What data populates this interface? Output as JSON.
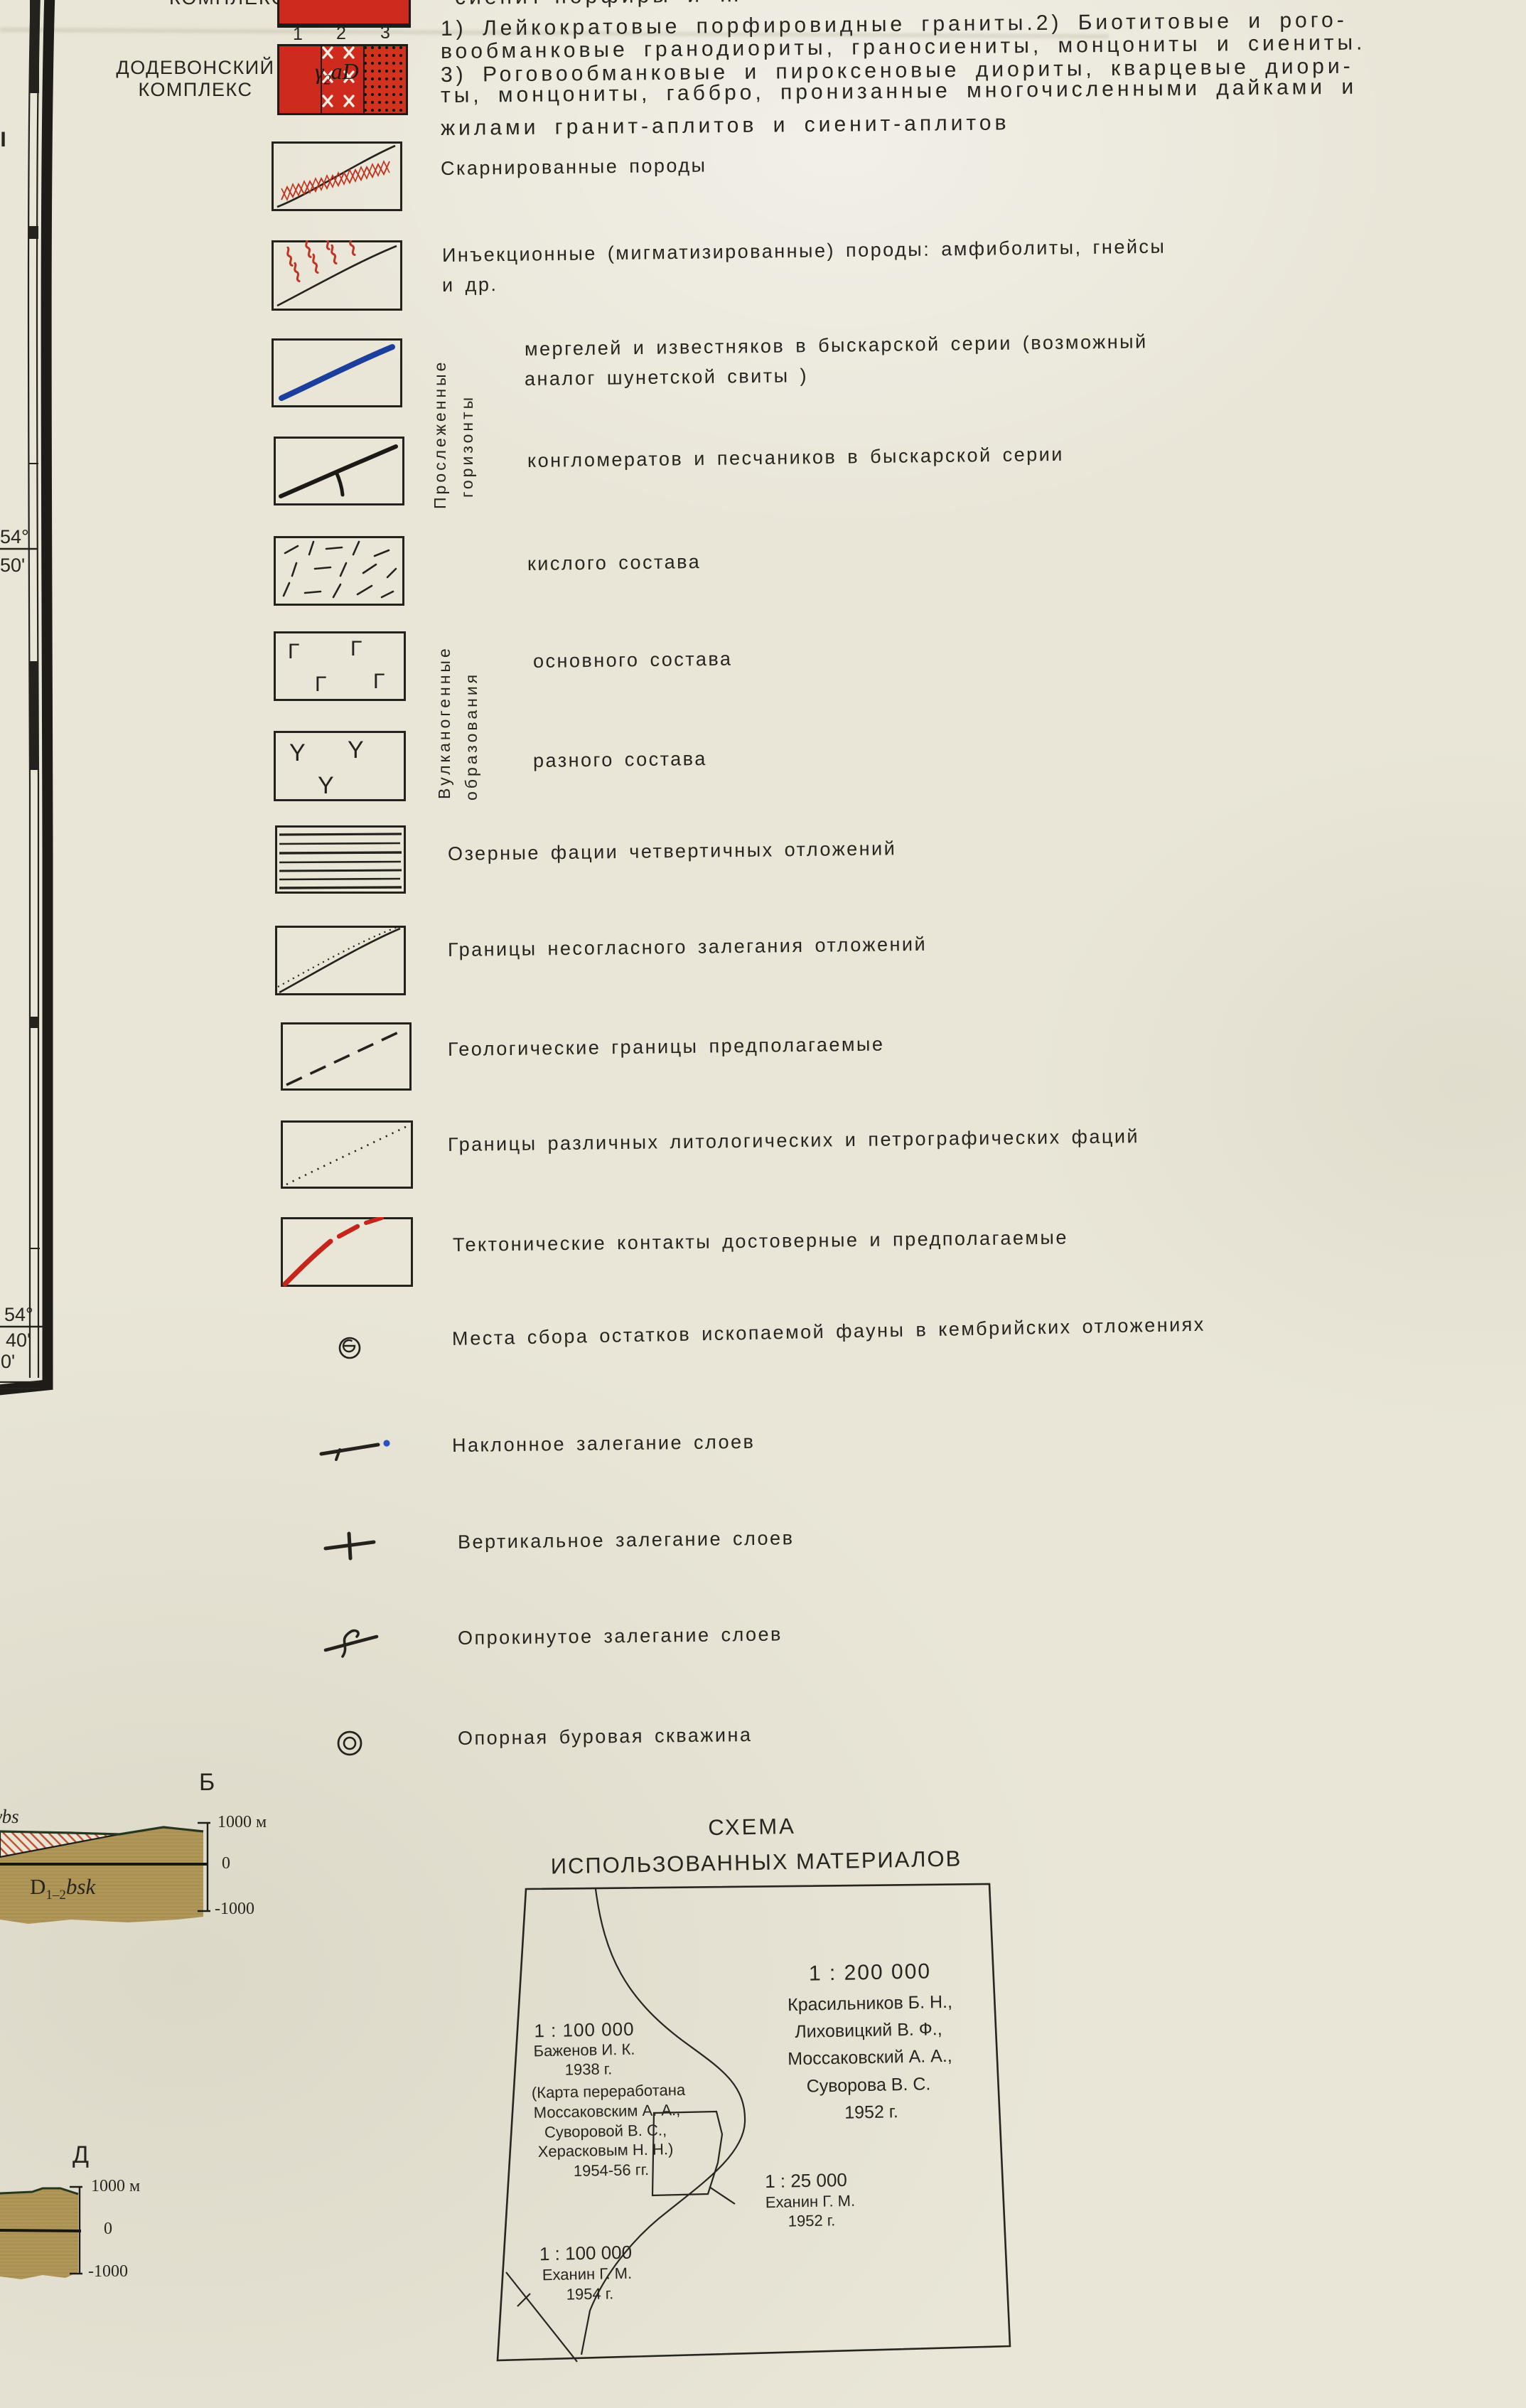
{
  "colors": {
    "paper": "#e9e6d8",
    "ink": "#26251f",
    "swatch_red": "#cf2a1e",
    "dot_red": "#d2331f",
    "hatch_red": "#c23220",
    "line_blue": "#1c3f9e",
    "olive_band": "#b09758",
    "tectonic_red": "#c6251c",
    "dip_dot_blue": "#2a52c0"
  },
  "edge": {
    "roman": "II",
    "lat_top": {
      "deg": "54°",
      "min": "50'"
    },
    "corner": {
      "deg": "54°",
      "min": "40'",
      "lon": "00'"
    }
  },
  "complex": {
    "header_fragment": "КОМПЛЕКС",
    "name_line1": "ДОДЕВОНСКИЙ",
    "name_line2": "КОМПЛЕКС",
    "numbers": [
      "1",
      "2",
      "3"
    ],
    "code": {
      "gamma": "γ",
      "sub": "2",
      "rest": "aD"
    },
    "desc_cut": "сиенит-порфиры и …",
    "desc": [
      "1) Лейкократовые порфировидные граниты.2) Биотитовые и рого-",
      "вообманковые гранодиориты, граносиениты, монцониты и сиениты.",
      "3) Роговообманковые и пироксеновые диориты, кварцевые диори-",
      "ты, монцониты, габбро, пронизанные многочисленными дайками и",
      "жилами гранит-аплитов и сиенит-аплитов"
    ]
  },
  "groups": {
    "traced": {
      "l1": "Прослеженные",
      "l2": "горизонты"
    },
    "volcanic": {
      "l1": "Вулканогенные",
      "l2": "образования"
    }
  },
  "legend": [
    {
      "label": "Скарнированные породы"
    },
    {
      "label": "Инъекционные (мигматизированные) породы: амфиболиты, гнейсы",
      "label2": "и др."
    },
    {
      "label": "мергелей и известняков в быскарской серии (возможный",
      "label2": "аналог шунетской свиты )"
    },
    {
      "label": "конгломератов и песчаников в быскарской серии"
    },
    {
      "label": "кислого состава"
    },
    {
      "label": "основного состава",
      "glyph": "Г"
    },
    {
      "label": "разного состава",
      "glyph": "Y"
    },
    {
      "label": "Озерные фации четвертичных отложений"
    },
    {
      "label": "Границы несогласного залегания отложений"
    },
    {
      "label": "Геологические границы предполагаемые"
    },
    {
      "label": "Границы различных литологических и петрографических фаций"
    },
    {
      "label": "Тектонические контакты достоверные и предполагаемые"
    },
    {
      "label": "Места сбора остатков ископаемой фауны в кембрийских отложениях"
    },
    {
      "label": "Наклонное залегание слоев"
    },
    {
      "label": "Вертикальное залегание слоев"
    },
    {
      "label": "Опрокинутое залегание слоев"
    },
    {
      "label": "Опорная буровая скважина"
    }
  ],
  "section_b": {
    "title": "Б",
    "edge_unit": "γbs",
    "unit": "D",
    "unit_sub": "1–2",
    "unit_rest": "bsk",
    "scale_top": "1000 м",
    "scale_zero": "0",
    "scale_bottom": "-1000"
  },
  "section_d": {
    "title": "Д",
    "scale_top": "1000 м",
    "scale_zero": "0",
    "scale_bottom": "-1000"
  },
  "schema": {
    "title1": "СХЕМА",
    "title2": "ИСПОЛЬЗОВАННЫХ МАТЕРИАЛОВ",
    "b200": {
      "scale": "1 : 200 000",
      "l": [
        "Красильников Б. Н.,",
        "Лиховицкий В. Ф.,",
        "Моссаковский А. А.,",
        "Суворова В. С.",
        "1952 г."
      ]
    },
    "bazh": {
      "scale": "1 : 100 000",
      "l": [
        "Баженов И. К.",
        "1938 г.",
        "(Карта переработана",
        "Моссаковским А. А.,",
        "Суворовой В. С.,",
        "Херасковым Н. Н.)",
        "1954-56 гг."
      ]
    },
    "ekh25": {
      "scale": "1 : 25 000",
      "l": [
        "Еханин Г. М.",
        "1952 г."
      ]
    },
    "ekh100": {
      "scale": "1 : 100 000",
      "l": [
        "Еханин Г. М.",
        "1954 г."
      ]
    }
  }
}
